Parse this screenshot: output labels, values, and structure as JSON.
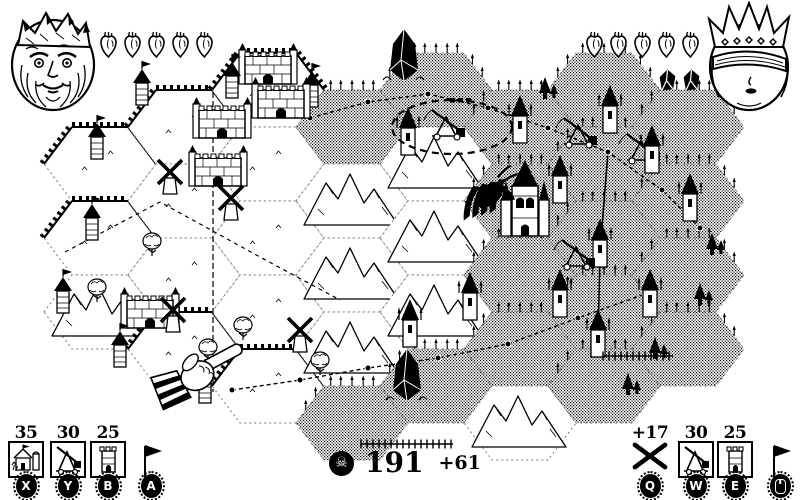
{
  "colors": {
    "ink": "#000000",
    "paper": "#ffffff"
  },
  "players": {
    "left": {
      "id": "king",
      "hearts": 5
    },
    "right": {
      "id": "queen",
      "hearts": 5,
      "gems": 2
    }
  },
  "hud": {
    "left_slots": [
      {
        "cost": "35",
        "icon": "farm",
        "key": "X"
      },
      {
        "cost": "30",
        "icon": "trebuchet",
        "key": "Y"
      },
      {
        "cost": "25",
        "icon": "tower",
        "key": "B"
      },
      {
        "cost": "",
        "icon": "flag",
        "key": "A"
      }
    ],
    "right_slots": [
      {
        "cost": "+17",
        "icon": "crossed",
        "key": "Q"
      },
      {
        "cost": "30",
        "icon": "trebuchet",
        "key": "W"
      },
      {
        "cost": "25",
        "icon": "tower",
        "key": "E"
      },
      {
        "cost": "",
        "icon": "flag",
        "key": "mouse"
      }
    ],
    "score": {
      "icon": "skull",
      "icon_glyph": "☠",
      "value": "191",
      "delta": "+61"
    }
  },
  "map": {
    "hex": {
      "w": 112,
      "h": 74,
      "stepx": 84,
      "ox": 100,
      "oy": 90
    },
    "hexes": [
      {
        "c": 0,
        "r": 1,
        "t": "plain",
        "w": 1
      },
      {
        "c": 0,
        "r": 2,
        "t": "plain",
        "w": 1
      },
      {
        "c": 0,
        "r": 3,
        "t": "mtn"
      },
      {
        "c": 1,
        "r": 0,
        "t": "plain",
        "w": 1
      },
      {
        "c": 1,
        "r": 1,
        "t": "plain"
      },
      {
        "c": 1,
        "r": 2,
        "t": "plain"
      },
      {
        "c": 1,
        "r": 3,
        "t": "plain",
        "w": 1
      },
      {
        "c": 2,
        "r": 0,
        "t": "plain",
        "w": 1
      },
      {
        "c": 2,
        "r": 1,
        "t": "plain"
      },
      {
        "c": 2,
        "r": 2,
        "t": "plain"
      },
      {
        "c": 2,
        "r": 3,
        "t": "plain"
      },
      {
        "c": 2,
        "r": 4,
        "t": "plain",
        "w": 1
      },
      {
        "c": 3,
        "r": 0,
        "t": "dither"
      },
      {
        "c": 3,
        "r": 1,
        "t": "mtn"
      },
      {
        "c": 3,
        "r": 2,
        "t": "mtn"
      },
      {
        "c": 3,
        "r": 3,
        "t": "mtn"
      },
      {
        "c": 3,
        "r": 4,
        "t": "dither"
      },
      {
        "c": 4,
        "r": 0,
        "t": "dither"
      },
      {
        "c": 4,
        "r": 1,
        "t": "mtn"
      },
      {
        "c": 4,
        "r": 2,
        "t": "mtn"
      },
      {
        "c": 4,
        "r": 3,
        "t": "mtn"
      },
      {
        "c": 4,
        "r": 4,
        "t": "dither"
      },
      {
        "c": 5,
        "r": 0,
        "t": "dither"
      },
      {
        "c": 5,
        "r": 1,
        "t": "dither"
      },
      {
        "c": 5,
        "r": 2,
        "t": "dither"
      },
      {
        "c": 5,
        "r": 3,
        "t": "dither"
      },
      {
        "c": 5,
        "r": 4,
        "t": "mtn"
      },
      {
        "c": 6,
        "r": 0,
        "t": "dither"
      },
      {
        "c": 6,
        "r": 1,
        "t": "dither"
      },
      {
        "c": 6,
        "r": 2,
        "t": "dither"
      },
      {
        "c": 6,
        "r": 3,
        "t": "dither"
      },
      {
        "c": 6,
        "r": 4,
        "t": "dither"
      },
      {
        "c": 7,
        "r": 0,
        "t": "dither"
      },
      {
        "c": 7,
        "r": 1,
        "t": "dither"
      },
      {
        "c": 7,
        "r": 2,
        "t": "dither"
      },
      {
        "c": 7,
        "r": 3,
        "t": "dither"
      }
    ],
    "features": [
      {
        "type": "crystal",
        "x": 404,
        "y": 66
      },
      {
        "type": "crystal",
        "x": 407,
        "y": 386
      },
      {
        "type": "keep",
        "x": 222,
        "y": 124
      },
      {
        "type": "keep",
        "x": 281,
        "y": 104
      },
      {
        "type": "keep",
        "x": 218,
        "y": 172
      },
      {
        "type": "keep",
        "x": 150,
        "y": 314
      },
      {
        "type": "keep",
        "x": 268,
        "y": 70
      },
      {
        "type": "windmill",
        "x": 170,
        "y": 180
      },
      {
        "type": "windmill",
        "x": 231,
        "y": 206
      },
      {
        "type": "windmill",
        "x": 173,
        "y": 318
      },
      {
        "type": "windmill",
        "x": 300,
        "y": 338
      },
      {
        "type": "tower",
        "x": 142,
        "y": 92
      },
      {
        "type": "tower",
        "x": 232,
        "y": 85
      },
      {
        "type": "tower",
        "x": 312,
        "y": 94
      },
      {
        "type": "tower",
        "x": 97,
        "y": 146
      },
      {
        "type": "tower",
        "x": 92,
        "y": 227
      },
      {
        "type": "tower",
        "x": 63,
        "y": 300
      },
      {
        "type": "tower",
        "x": 120,
        "y": 354
      },
      {
        "type": "tower",
        "x": 205,
        "y": 390
      },
      {
        "type": "gtower",
        "x": 520,
        "y": 128
      },
      {
        "type": "gtower",
        "x": 560,
        "y": 188
      },
      {
        "type": "gtower",
        "x": 610,
        "y": 118
      },
      {
        "type": "gtower",
        "x": 652,
        "y": 158
      },
      {
        "type": "gtower",
        "x": 690,
        "y": 206
      },
      {
        "type": "gtower",
        "x": 600,
        "y": 252
      },
      {
        "type": "gtower",
        "x": 650,
        "y": 302
      },
      {
        "type": "gtower",
        "x": 598,
        "y": 342
      },
      {
        "type": "gtower",
        "x": 560,
        "y": 302
      },
      {
        "type": "gtower",
        "x": 470,
        "y": 305
      },
      {
        "type": "gtower",
        "x": 408,
        "y": 140
      },
      {
        "type": "gtower",
        "x": 410,
        "y": 332
      },
      {
        "type": "cathedral",
        "x": 525,
        "y": 212
      },
      {
        "type": "trebuchet",
        "x": 580,
        "y": 134
      },
      {
        "type": "trebuchet",
        "x": 643,
        "y": 150
      },
      {
        "type": "trebuchet",
        "x": 578,
        "y": 256
      },
      {
        "type": "trebuchet",
        "x": 448,
        "y": 126
      },
      {
        "type": "pine",
        "x": 700,
        "y": 298
      },
      {
        "type": "pine",
        "x": 712,
        "y": 248
      },
      {
        "type": "pine",
        "x": 545,
        "y": 92
      },
      {
        "type": "pine",
        "x": 655,
        "y": 352
      },
      {
        "type": "pine",
        "x": 628,
        "y": 388
      },
      {
        "type": "tree",
        "x": 97,
        "y": 292
      },
      {
        "type": "tree",
        "x": 152,
        "y": 246
      },
      {
        "type": "tree",
        "x": 243,
        "y": 330
      },
      {
        "type": "tree",
        "x": 208,
        "y": 352
      },
      {
        "type": "tree",
        "x": 320,
        "y": 365
      },
      {
        "type": "fence",
        "x": 407,
        "y": 444,
        "len": 92
      },
      {
        "type": "fence",
        "x": 638,
        "y": 356,
        "len": 70
      },
      {
        "type": "dots",
        "x": 450,
        "y": 98
      },
      {
        "type": "claw",
        "x": 477,
        "y": 185,
        "rot": -15
      },
      {
        "type": "hand",
        "x": 200,
        "y": 372,
        "rot": -28
      }
    ],
    "routes": [
      {
        "pts": [
          [
            213,
            92
          ],
          [
            213,
            392
          ]
        ],
        "dash": "6 3",
        "w": 1.2,
        "nodes": false
      },
      {
        "pts": [
          [
            310,
            118
          ],
          [
            368,
            102
          ],
          [
            428,
            94
          ],
          [
            488,
            108
          ],
          [
            548,
            128
          ],
          [
            608,
            152
          ],
          [
            662,
            190
          ],
          [
            700,
            228
          ]
        ],
        "dash": "4 3",
        "w": 1.4,
        "nodes": true
      },
      {
        "pts": [
          [
            232,
            390
          ],
          [
            300,
            380
          ],
          [
            368,
            368
          ],
          [
            438,
            358
          ],
          [
            508,
            344
          ],
          [
            578,
            318
          ],
          [
            645,
            294
          ]
        ],
        "dash": "4 3",
        "w": 1.4,
        "nodes": true
      },
      {
        "pts": [
          [
            65,
            252
          ],
          [
            160,
            202
          ],
          [
            260,
            257
          ],
          [
            340,
            300
          ]
        ],
        "dash": "4 4",
        "w": 1.2,
        "nodes": false
      },
      {
        "pts": [
          [
            608,
            152
          ],
          [
            600,
            252
          ],
          [
            598,
            342
          ]
        ],
        "dash": "",
        "w": 1.6,
        "nodes": true
      }
    ],
    "selection": {
      "cx": 452,
      "cy": 127,
      "rx": 60,
      "ry": 27
    }
  }
}
